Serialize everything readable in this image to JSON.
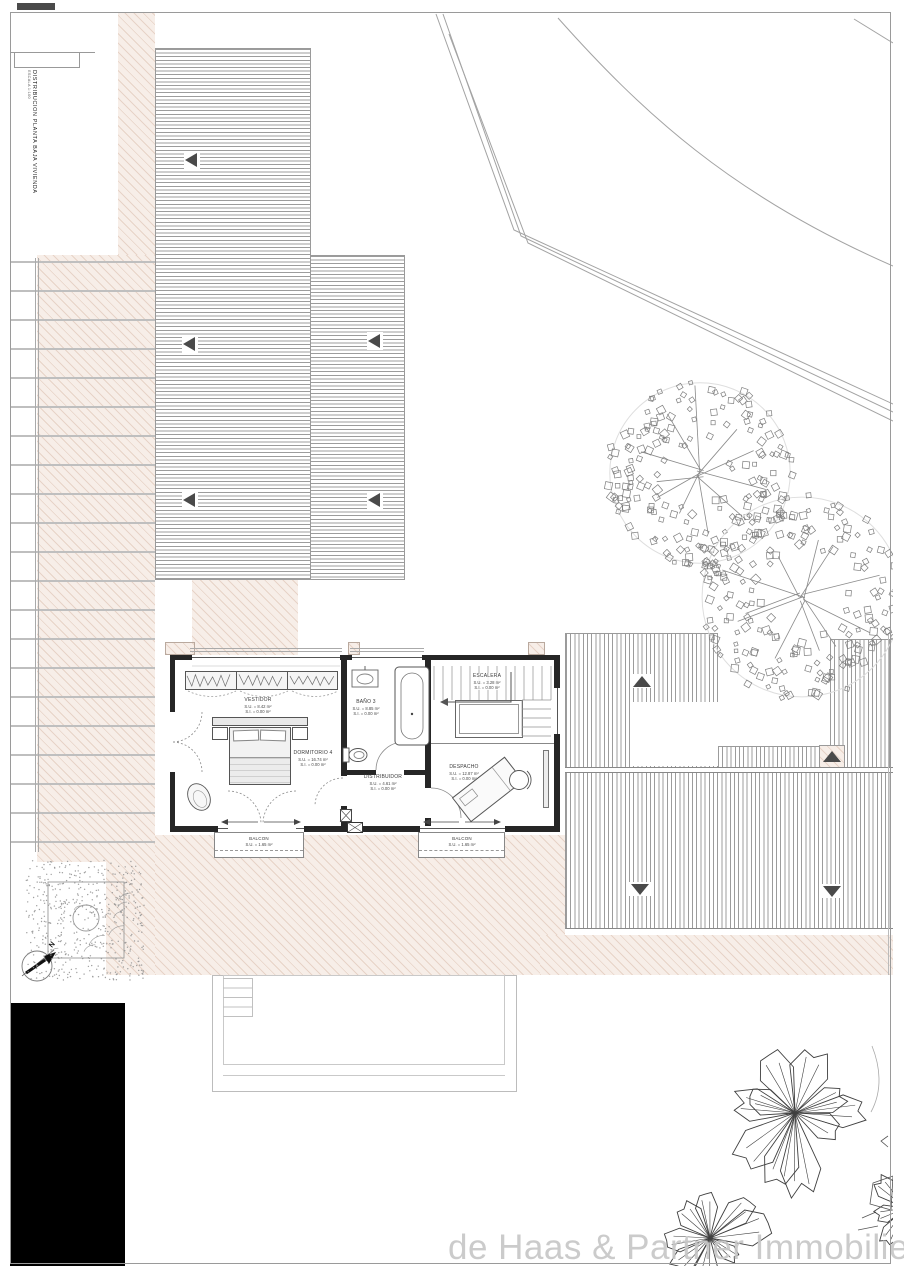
{
  "title_block": {
    "title": "DISTRIBUCION PLANTA BAJA VIVIENDA",
    "scale": "ESCALA 1:100"
  },
  "watermark": "de Haas & Partner Immobilien",
  "compass": {
    "label": "N"
  },
  "rooms": {
    "vestidor": {
      "name": "VESTIDOR",
      "su": "S.U. = 8.42 m²",
      "si": "S.I. = 0.00 m²"
    },
    "dormitorio4": {
      "name": "DORMITORIO 4",
      "su": "S.U. = 16.74 m²",
      "si": "S.I. = 0.00 m²"
    },
    "bano3": {
      "name": "BAÑO 3",
      "su": "S.U. = 8.85 m²",
      "si": "S.I. = 0.00 m²"
    },
    "escalera": {
      "name": "ESCALERA",
      "su": "S.U. = 3.28 m²",
      "si": "S.I. = 0.00 m²"
    },
    "distribuidor": {
      "name": "DISTRIBUIDOR",
      "su": "S.U. = 4.61 m²",
      "si": "S.I. = 0.00 m²"
    },
    "despacho": {
      "name": "DESPACHO",
      "su": "S.U. = 12.87 m²",
      "si": "S.I. = 0.00 m²"
    },
    "balcon_left": {
      "name": "BALCON",
      "su": "S.U. = 1.65 m²"
    },
    "balcon_right": {
      "name": "BALCON",
      "su": "S.U. = 1.65 m²"
    }
  },
  "colors": {
    "hatch": "#f7eee8",
    "hatch_line": "#e7d3c7",
    "wall": "#262626",
    "line": "#9a9a9a",
    "arrow": "#4a4a4a",
    "watermark": "#c6c6c6",
    "black_block": "#000000"
  }
}
